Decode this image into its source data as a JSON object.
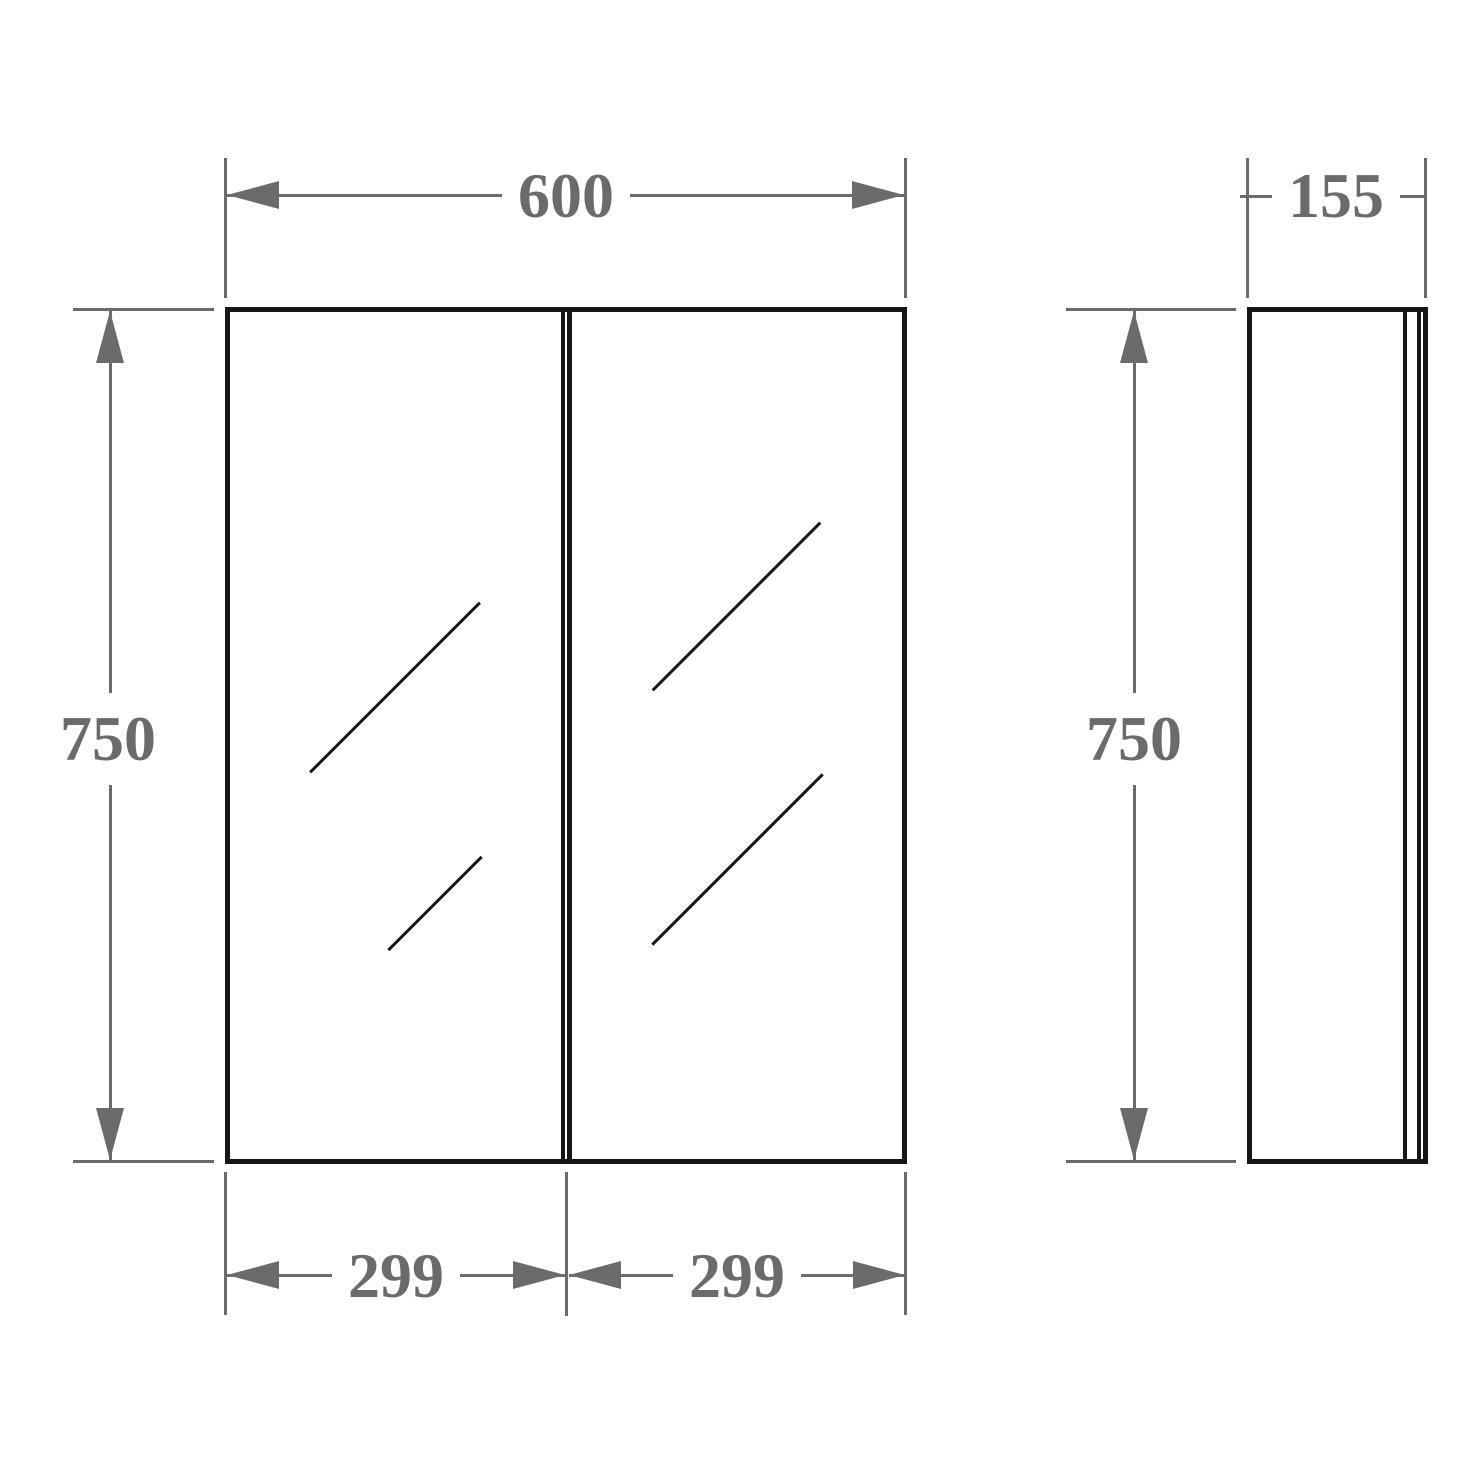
{
  "drawing": {
    "type": "furniture-technical-drawing",
    "subject": "two-door mirrored cabinet, front and side elevation"
  },
  "dimensions": {
    "front_width": "600",
    "front_height": "750",
    "door_left_width": "299",
    "door_right_width": "299",
    "side_depth": "155",
    "side_height": "750"
  },
  "colors": {
    "line": "#161616",
    "dim": "#6b6b6b",
    "bg": "#ffffff"
  }
}
